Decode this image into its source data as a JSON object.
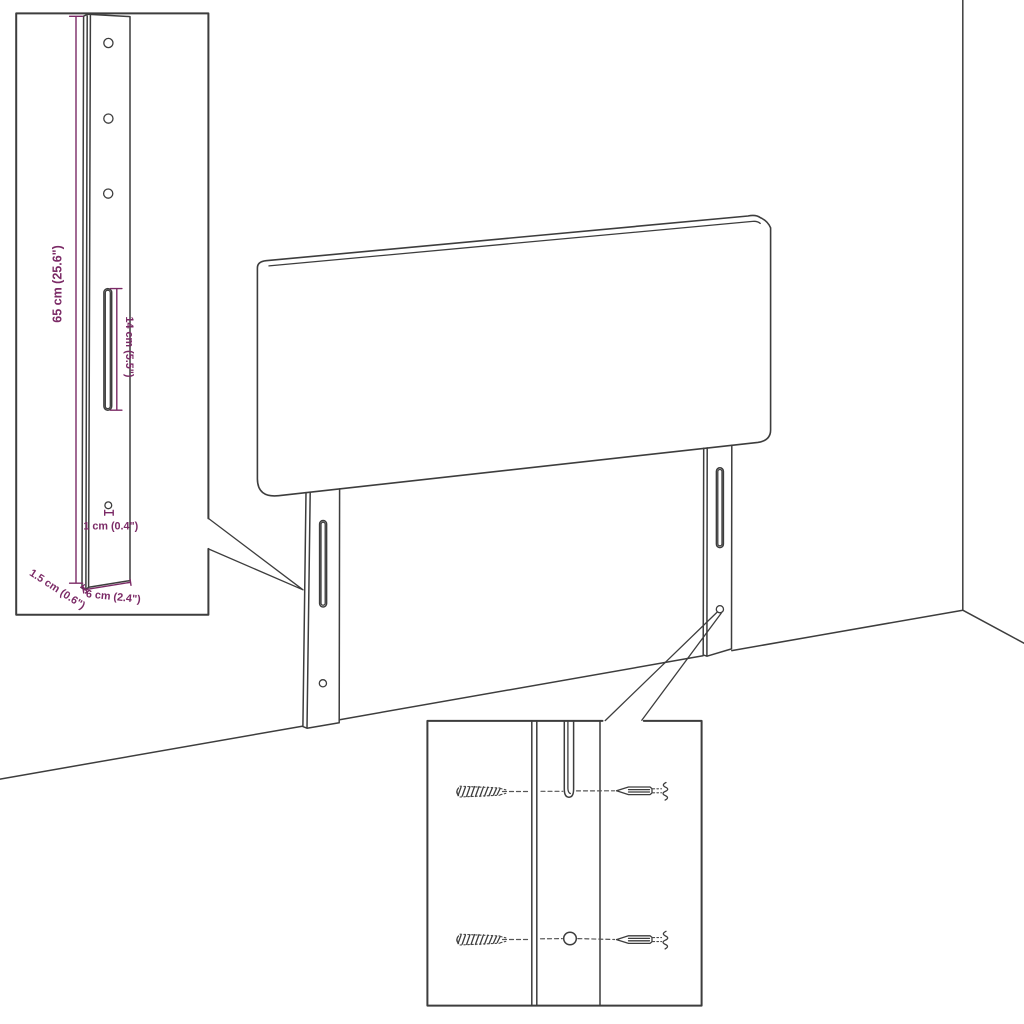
{
  "labels": {
    "leg_height": "65 cm (25.6\")",
    "slot_height": "14 cm (5.5\")",
    "hole_diameter": "1 cm (0.4\")",
    "leg_thickness": "1.5 cm (0.6\")",
    "leg_width": "6 cm (2.4\")"
  },
  "colors": {
    "outline": "#3d3d3d",
    "dimension": "#7b2a66",
    "background": "#ffffff"
  }
}
